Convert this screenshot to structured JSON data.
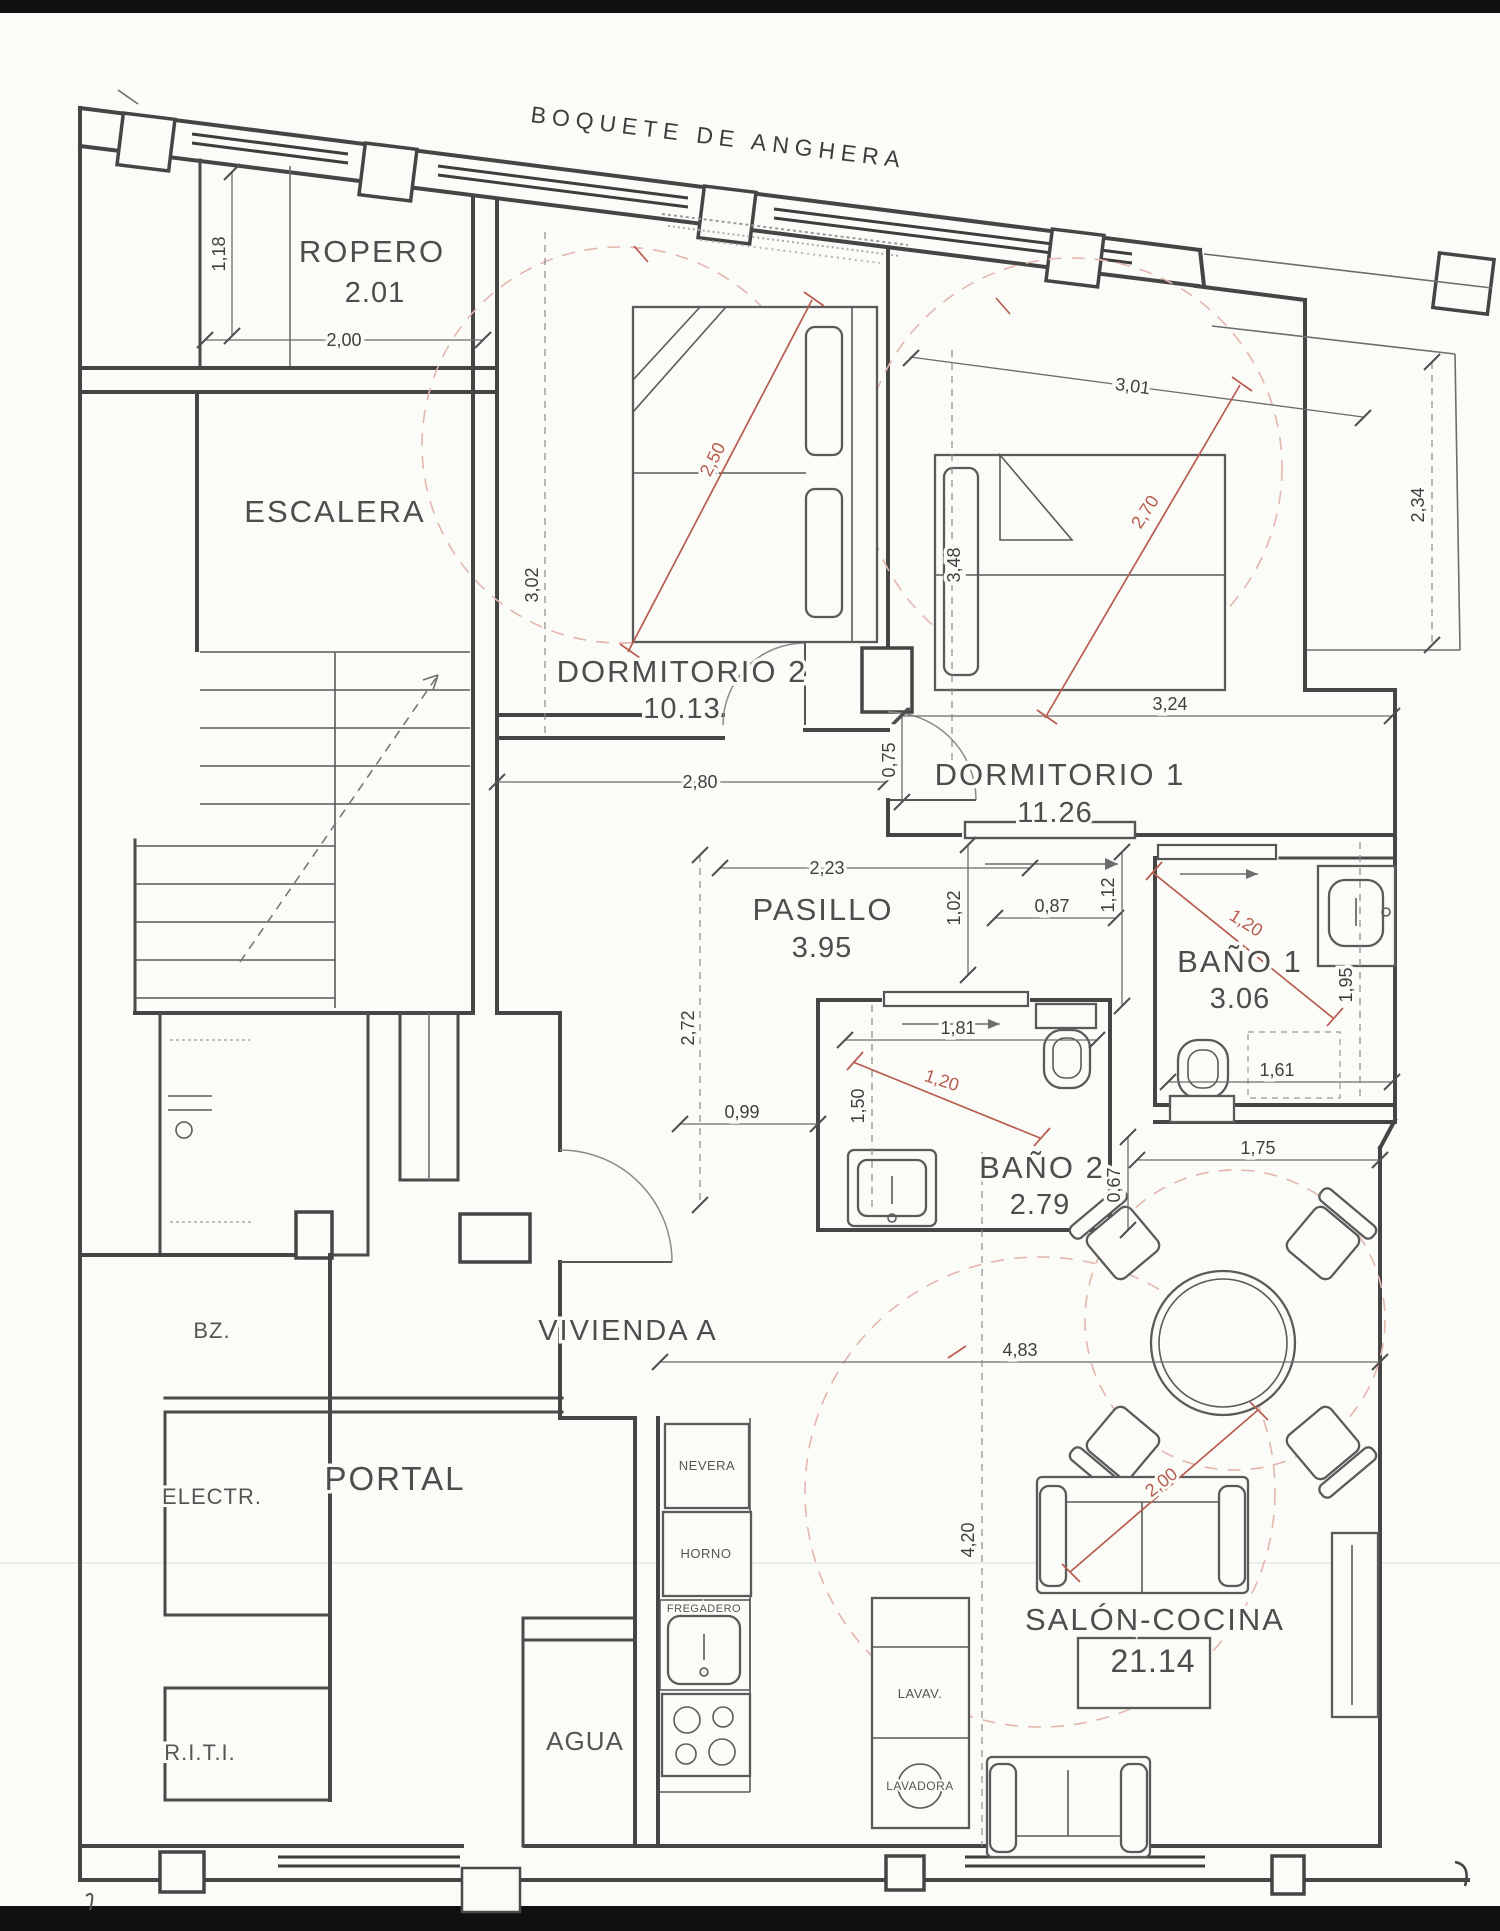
{
  "street_label": "BOQUETE DE ANGHERA",
  "unit_label": "VIVIENDA A",
  "rooms": {
    "ropero": {
      "name": "ROPERO",
      "area": "2.01"
    },
    "escalera": {
      "name": "ESCALERA"
    },
    "dormitorio2": {
      "name": "DORMITORIO 2",
      "area": "10.13"
    },
    "dormitorio1": {
      "name": "DORMITORIO 1",
      "area": "11.26"
    },
    "pasillo": {
      "name": "PASILLO",
      "area": "3.95"
    },
    "bano1": {
      "name": "BAÑO 1",
      "area": "3.06"
    },
    "bano2": {
      "name": "BAÑO 2",
      "area": "2.79"
    },
    "salon": {
      "name": "SALÓN-COCINA",
      "area": "21.14"
    },
    "portal": {
      "name": "PORTAL"
    },
    "agua": {
      "name": "AGUA"
    },
    "bz": {
      "name": "BZ."
    },
    "electr": {
      "name": "ELECTR."
    },
    "riti": {
      "name": "R.I.T.I."
    }
  },
  "appliances": {
    "nevera": "NEVERA",
    "horno": "HORNO",
    "fregadero": "FREGADERO",
    "lavavajillas": "LAVAV.",
    "lavadora": "LAVADORA"
  },
  "dims": {
    "ropero_w": "2,00",
    "ropero_d": "1,18",
    "dorm2_h": "3,02",
    "dorm2_w": "2,80",
    "dorm2_diag": "2,50",
    "jamb": "0,75",
    "dorm1_win": "3,01",
    "dorm1_side": "3,48",
    "dorm1_w": "3,24",
    "dorm1_diag": "2,70",
    "terrace_h": "2,34",
    "pasillo_w": "2,23",
    "pas_a": "1,02",
    "pas_b": "0,87",
    "pas_c": "1,12",
    "hall_w": "0,99",
    "hall_l": "2,72",
    "bano1_diag": "1,20",
    "bano1_w": "1,61",
    "bano1_h": "1,95",
    "bano2_w": "1,81",
    "bano2_h": "1,50",
    "bano2_diag": "1,20",
    "niche_w": "1,75",
    "niche_h": "0,67",
    "salon_w": "4,83",
    "salon_l": "4,20",
    "sofa_w": "2,00"
  },
  "colors": {
    "paper": "#fbfbf8",
    "wall": "#454545",
    "red_dimension": "#b85c50",
    "pink_dashed": "#e3b7ae"
  }
}
